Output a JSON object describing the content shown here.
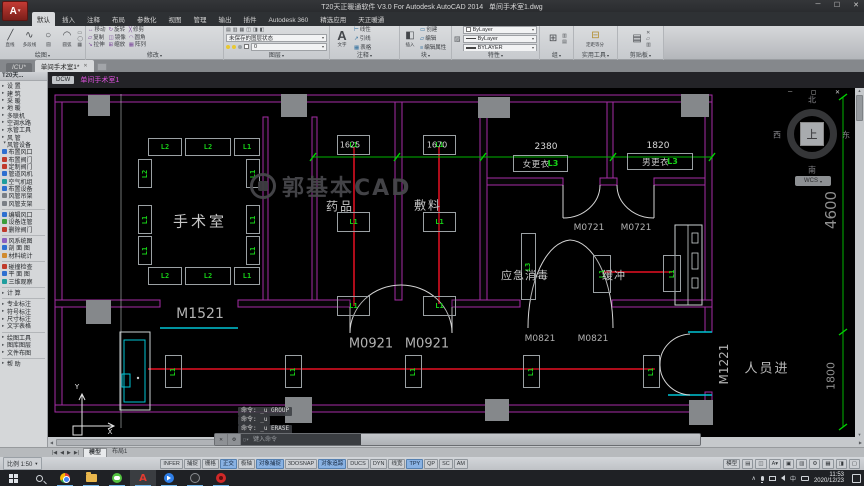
{
  "window": {
    "title": "T20天正暖通软件 V3.0 For Autodesk AutoCAD 2014",
    "document": "单间手术室1.dwg"
  },
  "ribbon": {
    "tabs": [
      {
        "label": "默认",
        "state": "on"
      },
      {
        "label": "插入",
        "state": "off"
      },
      {
        "label": "注释",
        "state": "off"
      },
      {
        "label": "布局",
        "state": "off"
      },
      {
        "label": "参数化",
        "state": "off"
      },
      {
        "label": "视图",
        "state": "off"
      },
      {
        "label": "管理",
        "state": "off"
      },
      {
        "label": "输出",
        "state": "off"
      },
      {
        "label": "插件",
        "state": "off"
      },
      {
        "label": "Autodesk 360",
        "state": "off"
      },
      {
        "label": "精选应用",
        "state": "off"
      },
      {
        "label": "天正暖通",
        "state": "off"
      }
    ],
    "draw_panel": {
      "label": "绘图",
      "tools": [
        "直线",
        "多段线",
        "圆",
        "圆弧"
      ]
    },
    "modify_panel": {
      "label": "修改",
      "tools": [
        "移动",
        "旋转",
        "修剪",
        "复制",
        "镜像",
        "圆角",
        "拉伸",
        "缩放",
        "阵列"
      ]
    },
    "layers_panel": {
      "label": "图层",
      "state_text": "未保存的图层状态",
      "current_layer": "0"
    },
    "annotate_panel": {
      "label": "注释",
      "text_tool": "文字",
      "rows": [
        "线性",
        "引线",
        "表格"
      ]
    },
    "block_panel": {
      "label": "块",
      "insert_tool": "插入",
      "rows": [
        "创建",
        "编辑",
        "编辑属性"
      ]
    },
    "properties_panel": {
      "label": "特性",
      "values": [
        "ByLayer",
        "ByLayer",
        "BYLAYER"
      ]
    },
    "group_panel": {
      "label": "组"
    },
    "utils_panel": {
      "label": "实用工具",
      "tool": "定距等分"
    },
    "clipboard_panel": {
      "label": "剪贴板"
    }
  },
  "file_tabs": {
    "tabs": [
      {
        "label": "ICU*",
        "state": "off"
      },
      {
        "label": "单间手术室1*",
        "state": "on"
      }
    ]
  },
  "palette": {
    "header": "T20天...",
    "items": [
      {
        "label": "设  置",
        "type": "group"
      },
      {
        "label": "建  筑",
        "type": "group"
      },
      {
        "label": "采  暖",
        "type": "group"
      },
      {
        "label": "地  暖",
        "type": "group"
      },
      {
        "label": "多联机",
        "type": "group"
      },
      {
        "label": "空调水路",
        "type": "group"
      },
      {
        "label": "水管工具",
        "type": "group"
      },
      {
        "label": "风  管",
        "type": "group"
      },
      {
        "label": "风管设备",
        "type": "groupopen"
      },
      {
        "label": "布置风口",
        "type": "leaf",
        "icon": "air-outlet-icon",
        "color": "#2e6fd0"
      },
      {
        "label": "布置阀门",
        "type": "leaf",
        "icon": "place-valve-icon",
        "color": "#c03a2b"
      },
      {
        "label": "定制阀门",
        "type": "leaf",
        "icon": "custom-valve-icon",
        "color": "#c03a2b"
      },
      {
        "label": "管道风机",
        "type": "leaf",
        "icon": "duct-fan-icon",
        "color": "#2e6fd0"
      },
      {
        "label": "空气机组",
        "type": "leaf",
        "icon": "ahu-icon",
        "color": "#1f9e9e"
      },
      {
        "label": "布置设备",
        "type": "leaf",
        "icon": "equipment-icon",
        "color": "#2e6fd0"
      },
      {
        "label": "风管吊架",
        "type": "leaf",
        "icon": "duct-hanger-icon",
        "color": "#7a7f85"
      },
      {
        "label": "风管支架",
        "type": "leaf",
        "icon": "duct-support-icon",
        "color": "#7a7f85"
      },
      {
        "type": "sep"
      },
      {
        "label": "编辑风口",
        "type": "leaf",
        "icon": "edit-outlet-icon",
        "color": "#2e6fd0"
      },
      {
        "label": "设备连管",
        "type": "leaf",
        "icon": "connect-pipe-icon",
        "color": "#3a9e3a"
      },
      {
        "label": "删除阀门",
        "type": "leaf",
        "icon": "delete-valve-icon",
        "color": "#c03a2b"
      },
      {
        "type": "sep"
      },
      {
        "label": "风系统图",
        "type": "leaf",
        "icon": "air-system-diagram-icon",
        "color": "#8a5fc0"
      },
      {
        "label": "剖 面 图",
        "type": "leaf",
        "icon": "section-view-icon",
        "color": "#2e6fd0"
      },
      {
        "label": "材料统计",
        "type": "leaf",
        "icon": "material-stats-icon",
        "color": "#d08a2e"
      },
      {
        "type": "sep"
      },
      {
        "label": "碰撞检查",
        "type": "leaf",
        "icon": "clash-check-icon",
        "color": "#c03a2b"
      },
      {
        "label": "平 面 图",
        "type": "leaf",
        "icon": "plan-view-icon",
        "color": "#2e6fd0"
      },
      {
        "label": "三维观察",
        "type": "leaf",
        "icon": "view-3d-icon",
        "color": "#1f9e9e"
      },
      {
        "type": "sep"
      },
      {
        "label": "计  算",
        "type": "group"
      },
      {
        "type": "sep"
      },
      {
        "label": "专业标注",
        "type": "group"
      },
      {
        "label": "符号标注",
        "type": "group"
      },
      {
        "label": "尺寸标注",
        "type": "group"
      },
      {
        "label": "文字表格",
        "type": "group"
      },
      {
        "type": "sep"
      },
      {
        "label": "绘图工具",
        "type": "group"
      },
      {
        "label": "图库图层",
        "type": "group"
      },
      {
        "label": "文件布图",
        "type": "group"
      },
      {
        "type": "sep"
      },
      {
        "label": "帮  助",
        "type": "group"
      }
    ]
  },
  "doc_bar": {
    "button": "DCW",
    "doc_name": "单间手术室1"
  },
  "canvas": {
    "rooms": {
      "operating_room": "手术室",
      "medicine": "药品",
      "dressing": "敷料",
      "women_change": "女更衣",
      "men_change": "男更衣",
      "emergency_disinfect": "应急消毒",
      "buffer": "缓冲"
    },
    "or_ring": {
      "top": [
        "L2",
        "L2",
        "L1"
      ],
      "bottom": [
        "L2",
        "L2",
        "L1"
      ],
      "left": [
        "L2",
        "L1",
        "L1"
      ],
      "right": [
        "L1",
        "L1",
        "L1"
      ]
    },
    "medicine_lights": [
      "L1",
      "L1",
      "L1"
    ],
    "dressing_lights": [
      "L1",
      "L1",
      "L1"
    ],
    "buffer_lights": [
      "L1",
      "L1"
    ],
    "corridor_lights": [
      "L1",
      "L1",
      "L1",
      "L1",
      "L1"
    ],
    "room_light_tags": {
      "women_change": "L3",
      "men_change": "L3",
      "emergency": "L3"
    },
    "doors": {
      "m1521": "M1521",
      "m0921a": "M0921",
      "m0921b": "M0921",
      "m0721a": "M0721",
      "m0721b": "M0721",
      "m0821a": "M0821",
      "m0821b": "M0821",
      "m1221": "M1221"
    },
    "dims": {
      "d1625": "1625",
      "d1670": "1670",
      "d2380": "2380",
      "d1820": "1820",
      "d4600": "4600",
      "d1800": "1800"
    },
    "entry_label": "人员进",
    "watermark": "郭基本CAD",
    "viewcube": {
      "north": "北",
      "south": "南",
      "west": "西",
      "east": "东",
      "top": "上",
      "wcs": "WCS"
    },
    "ucs": {
      "x": "X",
      "y": "Y"
    }
  },
  "command": {
    "history": [
      "命令:  _u GROUP",
      "命令:  _u",
      "命令:  _u ERASE"
    ],
    "placeholder": "键入命令"
  },
  "layout_bar": {
    "tabs": [
      {
        "label": "模型",
        "state": "on"
      },
      {
        "label": "布局1",
        "state": "off"
      }
    ]
  },
  "status_bar": {
    "scale": "比例 1:50",
    "toggles": [
      {
        "label": "INFER",
        "state": "off"
      },
      {
        "label": "捕捉",
        "state": "off"
      },
      {
        "label": "栅格",
        "state": "off"
      },
      {
        "label": "正交",
        "state": "on"
      },
      {
        "label": "极轴",
        "state": "off"
      },
      {
        "label": "对象捕捉",
        "state": "on"
      },
      {
        "label": "3DOSNAP",
        "state": "off"
      },
      {
        "label": "对象追踪",
        "state": "on"
      },
      {
        "label": "DUCS",
        "state": "off"
      },
      {
        "label": "DYN",
        "state": "off"
      },
      {
        "label": "线宽",
        "state": "off"
      },
      {
        "label": "TPY",
        "state": "on"
      },
      {
        "label": "QP",
        "state": "off"
      },
      {
        "label": "SC",
        "state": "off"
      },
      {
        "label": "AM",
        "state": "off"
      }
    ],
    "mode": "模型"
  },
  "taskbar": {
    "ime": "中",
    "time": "11:53",
    "date": "2020/12/23"
  }
}
